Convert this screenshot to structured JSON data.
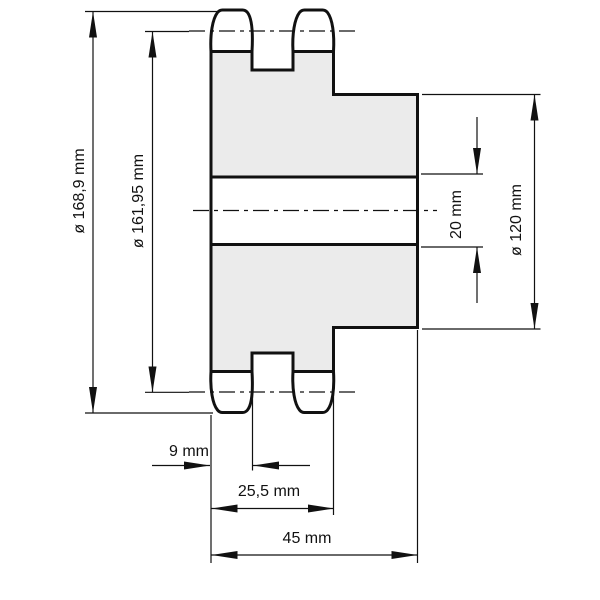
{
  "drawing": {
    "title": "duplex sprocket cross-section technical drawing",
    "unit": "mm",
    "labels": {
      "outer_diameter": "ø 168,9 mm",
      "pitch_diameter": "ø 161,95 mm",
      "bore_diameter": "20 mm",
      "hub_diameter": "ø 120 mm",
      "tooth_width": "9 mm",
      "teeth_span_width": "25,5 mm",
      "total_width": "45 mm"
    },
    "dimensions": [
      {
        "name": "outer_diameter",
        "value": 168.9,
        "unit": "mm",
        "kind": "diameter"
      },
      {
        "name": "pitch_diameter",
        "value": 161.95,
        "unit": "mm",
        "kind": "diameter"
      },
      {
        "name": "bore_diameter",
        "value": 20,
        "unit": "mm",
        "kind": "linear"
      },
      {
        "name": "hub_diameter",
        "value": 120,
        "unit": "mm",
        "kind": "diameter"
      },
      {
        "name": "tooth_width",
        "value": 9,
        "unit": "mm",
        "kind": "linear"
      },
      {
        "name": "teeth_span_width",
        "value": 25.5,
        "unit": "mm",
        "kind": "linear"
      },
      {
        "name": "total_width",
        "value": 45,
        "unit": "mm",
        "kind": "linear"
      }
    ],
    "colors": {
      "line": "#111111",
      "body_fill": "#ebebeb",
      "background": "#ffffff"
    }
  }
}
